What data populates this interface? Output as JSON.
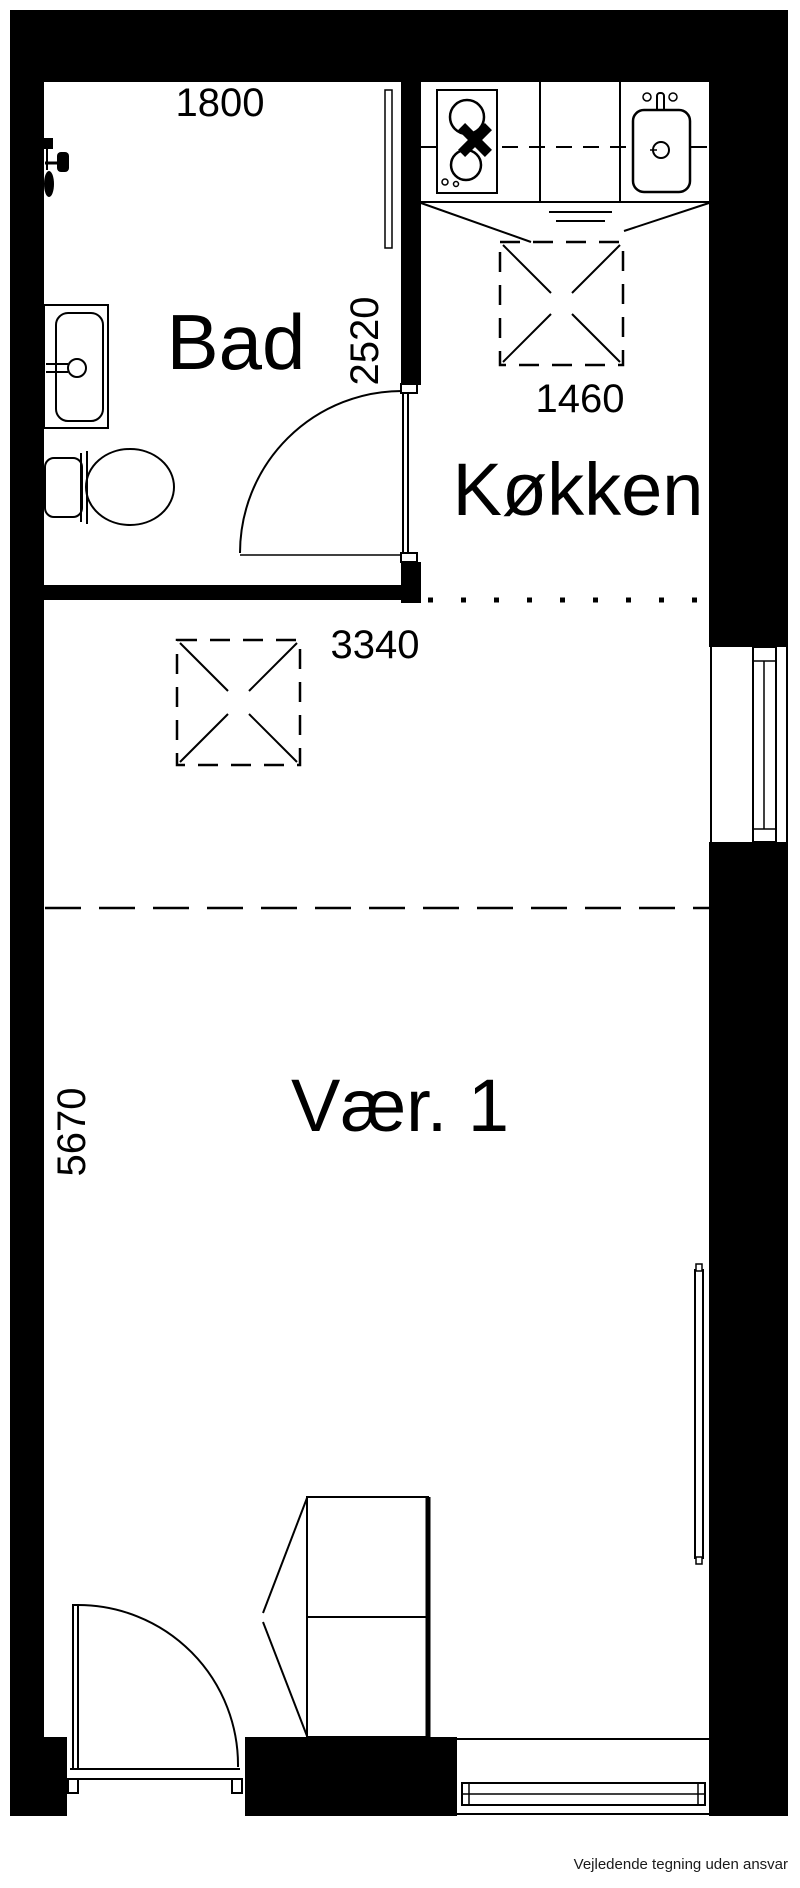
{
  "document": {
    "type": "floor-plan",
    "footer_disclaimer": "Vejledende tegning uden ansvar"
  },
  "rooms": {
    "bathroom": "Bad",
    "kitchen": "Køkken",
    "room1": "Vær. 1"
  },
  "dimensions_mm": {
    "bathroom_width": "1800",
    "bathroom_depth": "2520",
    "kitchen_marker": "1460",
    "room_marker": "3340",
    "room_depth": "5670"
  },
  "colors": {
    "ink": "#000000",
    "background": "#ffffff"
  }
}
